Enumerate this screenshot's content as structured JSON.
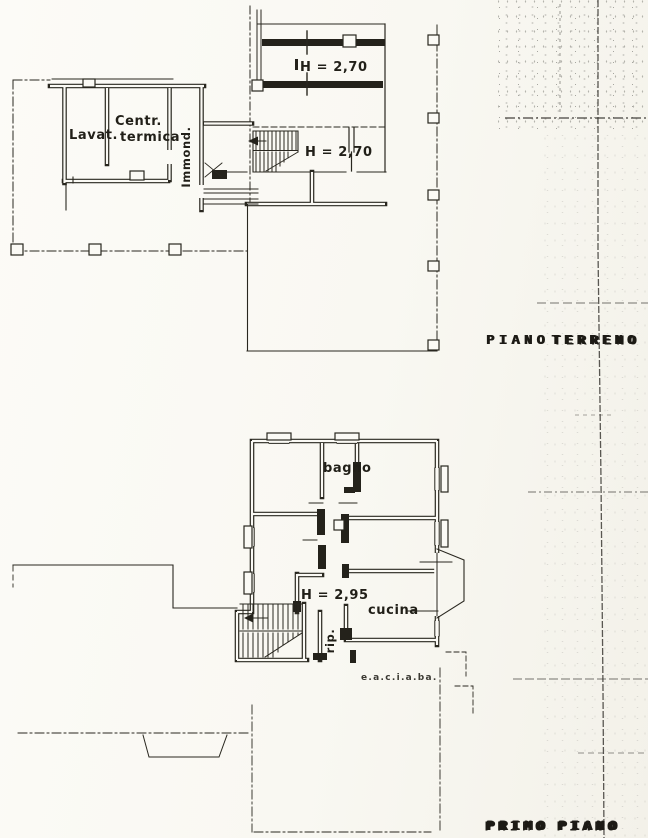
{
  "drawing": {
    "ground_floor": {
      "title_word1": "PIANO",
      "title_word2": "TERRENO",
      "rooms": {
        "lavatoio": "Lavat.",
        "centrale_line1": "Centr.",
        "centrale_line2": "termica",
        "immondezzaio": "Immond."
      },
      "heights": {
        "garage": "H = 2,70",
        "stairs": "H = 2,70"
      }
    },
    "first_floor": {
      "title_word1": "PRIMO",
      "title_word2": "PIANO",
      "rooms": {
        "bagno": "bagno",
        "cucina": "cucina",
        "ripostiglio": "rip."
      },
      "heights": {
        "hall": "H = 2,95"
      },
      "note": "e.a.c.i.a.ba."
    }
  }
}
